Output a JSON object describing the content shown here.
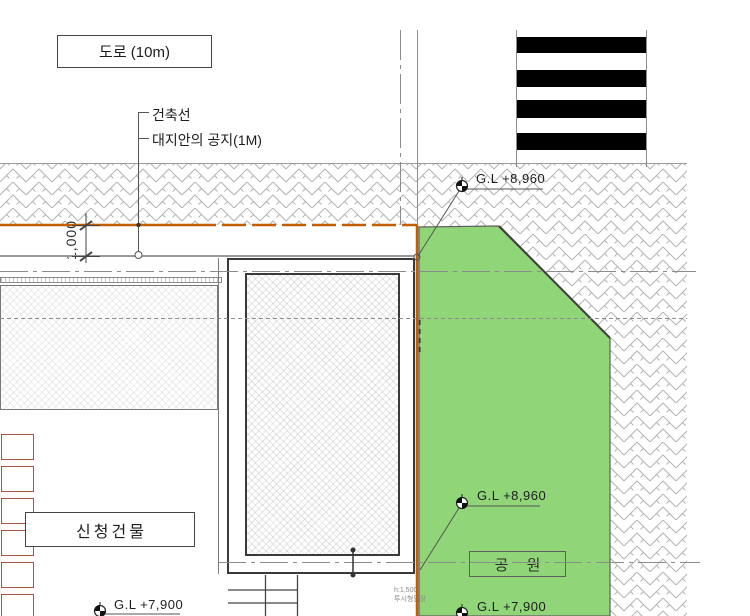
{
  "labels": {
    "road": "도로 (10m)",
    "building_line": "건축선",
    "setback": "대지안의 공지(1M)",
    "dimension": "1,000",
    "applicant_building": "신청건물",
    "park": "공 원",
    "fence_height": "h:1,500",
    "fence_type": "투시형담장"
  },
  "levels": {
    "gl_top": "G.L +8,960",
    "gl_mid": "G.L +8,960",
    "gl_bottom_left": "G.L +7,900",
    "gl_bottom_right": "G.L +7,900"
  },
  "colors": {
    "site_boundary_orange": "#c25e00",
    "park_green": "#90d678",
    "hatch_gray": "#b3b3b3",
    "crosswalk_black": "#000000",
    "planter_brown": "#a2573d"
  }
}
